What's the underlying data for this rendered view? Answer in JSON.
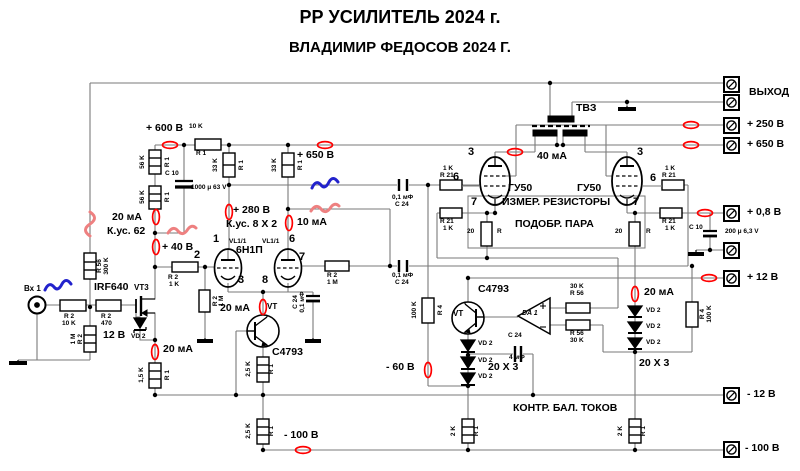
{
  "title": {
    "line1": "РР УСИЛИТЕЛЬ 2024 г.",
    "line2": "ВЛАДИМИР ФЕДОСОВ 2024 Г."
  },
  "colors": {
    "wire": "#7a7a7a",
    "symbol": "#000000",
    "measure_oval": "#ff0000",
    "squiggle_red": "#ee8080",
    "squiggle_blue": "#2222cc"
  },
  "terminals": [
    {
      "name": "terminal-output-1",
      "x": 723,
      "y": 76,
      "label": "ВЫХОД",
      "lx": 749,
      "ly": 87
    },
    {
      "name": "terminal-output-2",
      "x": 723,
      "y": 94,
      "label": "",
      "lx": 0,
      "ly": 0
    },
    {
      "name": "terminal-plus250v",
      "x": 723,
      "y": 117,
      "label": "+ 250 В",
      "lx": 747,
      "ly": 119
    },
    {
      "name": "terminal-plus650v",
      "x": 723,
      "y": 137,
      "label": "+ 650 В",
      "lx": 747,
      "ly": 139
    },
    {
      "name": "terminal-plus0v8",
      "x": 723,
      "y": 205,
      "label": "+ 0,8 В",
      "lx": 747,
      "ly": 207
    },
    {
      "name": "terminal-ground",
      "x": 723,
      "y": 242,
      "label": "",
      "lx": 0,
      "ly": 0
    },
    {
      "name": "terminal-plus12v",
      "x": 723,
      "y": 270,
      "label": "+ 12 В",
      "lx": 747,
      "ly": 272
    },
    {
      "name": "terminal-minus12v",
      "x": 723,
      "y": 387,
      "label": "- 12 В",
      "lx": 747,
      "ly": 389
    },
    {
      "name": "terminal-minus100v",
      "x": 723,
      "y": 441,
      "label": "- 100 В",
      "lx": 745,
      "ly": 443
    }
  ],
  "labels": [
    {
      "name": "label-plus600v",
      "text": "+ 600 В",
      "x": 146,
      "y": 123,
      "cls": "med"
    },
    {
      "name": "label-10k-top",
      "text": "10 K",
      "x": 189,
      "y": 124,
      "cls": "tiny"
    },
    {
      "name": "label-r1-10k",
      "text": "R 1",
      "x": 196,
      "y": 151,
      "cls": "tiny"
    },
    {
      "name": "label-plus650v-mid",
      "text": "+ 650 В",
      "x": 297,
      "y": 150,
      "cls": "med"
    },
    {
      "name": "label-plus280v",
      "text": "+ 280 В",
      "x": 233,
      "y": 205,
      "cls": "med"
    },
    {
      "name": "label-kus8x2",
      "text": "К.ус. 8 X 2",
      "x": 226,
      "y": 219,
      "cls": "med"
    },
    {
      "name": "label-10ma",
      "text": "10 мА",
      "x": 297,
      "y": 217,
      "cls": "med"
    },
    {
      "name": "label-20ma-left",
      "text": "20 мА",
      "x": 112,
      "y": 212,
      "cls": "med"
    },
    {
      "name": "label-kus62",
      "text": "К.ус. 62",
      "x": 107,
      "y": 226,
      "cls": "med"
    },
    {
      "name": "label-plus40v",
      "text": "+ 40 В",
      "x": 162,
      "y": 242,
      "cls": "med"
    },
    {
      "name": "label-12v",
      "text": "12 В",
      "x": 103,
      "y": 330,
      "cls": "med"
    },
    {
      "name": "label-vd2-mosfet",
      "text": "VD 2",
      "x": 131,
      "y": 334,
      "cls": "tiny"
    },
    {
      "name": "label-20ma-leftbottom",
      "text": "20 мА",
      "x": 163,
      "y": 344,
      "cls": "med"
    },
    {
      "name": "label-20ma-center",
      "text": "20 мА",
      "x": 220,
      "y": 303,
      "cls": "med"
    },
    {
      "name": "label-40ma",
      "text": "40 мА",
      "x": 537,
      "y": 151,
      "cls": "med"
    },
    {
      "name": "label-20ma-right",
      "text": "20 мА",
      "x": 644,
      "y": 287,
      "cls": "med"
    },
    {
      "name": "label-minus60v",
      "text": "- 60 В",
      "x": 386,
      "y": 362,
      "cls": "med"
    },
    {
      "name": "label-minus100v-mid",
      "text": "- 100 В",
      "x": 284,
      "y": 430,
      "cls": "med"
    },
    {
      "name": "label-20x3-center",
      "text": "20 X 3",
      "x": 488,
      "y": 362,
      "cls": "med"
    },
    {
      "name": "label-20x3-right",
      "text": "20 X 3",
      "x": 639,
      "y": 358,
      "cls": "med"
    },
    {
      "name": "label-izmer",
      "text": "ИЗМЕР. РЕЗИСТОРЫ",
      "x": 502,
      "y": 197,
      "cls": "med"
    },
    {
      "name": "label-podobr",
      "text": "ПОДОБР. ПАРА",
      "x": 515,
      "y": 219,
      "cls": "med"
    },
    {
      "name": "label-kontr",
      "text": "КОНТР. БАЛ. ТОКОВ",
      "x": 513,
      "y": 403,
      "cls": "med"
    },
    {
      "name": "label-tvz",
      "text": "ТВЗ",
      "x": 576,
      "y": 103,
      "cls": "med"
    },
    {
      "name": "label-irf640",
      "text": "IRF640",
      "x": 94,
      "y": 282,
      "cls": "med"
    },
    {
      "name": "label-vt3",
      "text": "VT3",
      "x": 134,
      "y": 284,
      "cls": "small"
    },
    {
      "name": "label-c4793-center",
      "text": "C4793",
      "x": 272,
      "y": 347,
      "cls": "med"
    },
    {
      "name": "label-c4793-right",
      "text": "C4793",
      "x": 478,
      "y": 284,
      "cls": "med"
    },
    {
      "name": "label-vt-center",
      "text": "VT",
      "x": 267,
      "y": 303,
      "cls": "small"
    },
    {
      "name": "label-vt-right",
      "text": "VT",
      "x": 453,
      "y": 310,
      "cls": "small"
    },
    {
      "name": "label-da1",
      "text": "DA 1",
      "x": 522,
      "y": 310,
      "cls": "ital"
    },
    {
      "name": "label-6n1p",
      "text": "6Н1П",
      "x": 236,
      "y": 245,
      "cls": "med"
    },
    {
      "name": "label-vl11-a",
      "text": "VL1/1",
      "x": 229,
      "y": 239,
      "cls": "tiny"
    },
    {
      "name": "label-vl11-b",
      "text": "VL1/1",
      "x": 262,
      "y": 239,
      "cls": "tiny"
    },
    {
      "name": "label-gu50-left",
      "text": "ГУ50",
      "x": 508,
      "y": 183,
      "cls": "med"
    },
    {
      "name": "label-gu50-right",
      "text": "ГУ50",
      "x": 577,
      "y": 183,
      "cls": "med"
    },
    {
      "name": "label-vh1",
      "text": "Вх 1",
      "x": 24,
      "y": 285,
      "cls": "small"
    },
    {
      "name": "pin-1",
      "text": "1",
      "x": 213,
      "y": 234,
      "cls": "pin"
    },
    {
      "name": "pin-2",
      "text": "2",
      "x": 194,
      "y": 250,
      "cls": "pin"
    },
    {
      "name": "pin-3",
      "text": "3",
      "x": 238,
      "y": 275,
      "cls": "pin"
    },
    {
      "name": "pin-6",
      "text": "6",
      "x": 289,
      "y": 234,
      "cls": "pin"
    },
    {
      "name": "pin-7",
      "text": "7",
      "x": 299,
      "y": 252,
      "cls": "pin"
    },
    {
      "name": "pin-8",
      "text": "8",
      "x": 262,
      "y": 275,
      "cls": "pin"
    },
    {
      "name": "pin-3-gu50l",
      "text": "3",
      "x": 468,
      "y": 147,
      "cls": "pin"
    },
    {
      "name": "pin-6-gu50l",
      "text": "6",
      "x": 453,
      "y": 172,
      "cls": "pin"
    },
    {
      "name": "pin-7-gu50l",
      "text": "7",
      "x": 471,
      "y": 197,
      "cls": "pin"
    },
    {
      "name": "pin-3-gu50r",
      "text": "3",
      "x": 637,
      "y": 147,
      "cls": "pin"
    },
    {
      "name": "pin-6-gu50r",
      "text": "6",
      "x": 650,
      "y": 173,
      "cls": "pin"
    },
    {
      "name": "pin-7-gu50r",
      "text": "7",
      "x": 633,
      "y": 197,
      "cls": "pin"
    },
    {
      "name": "label-c10-left",
      "text": "C 10",
      "x": 165,
      "y": 171,
      "cls": "tiny"
    },
    {
      "name": "label-1000u",
      "text": "1000 μ 63 V",
      "x": 191,
      "y": 185,
      "cls": "tiny"
    },
    {
      "name": "label-cap1-uf",
      "text": "0,1 мФ",
      "x": 392,
      "y": 195,
      "cls": "tiny"
    },
    {
      "name": "label-cap1-c24",
      "text": "C 24",
      "x": 395,
      "y": 202,
      "cls": "tiny"
    },
    {
      "name": "label-cap2-uf",
      "text": "0,1 мФ",
      "x": 392,
      "y": 273,
      "cls": "tiny"
    },
    {
      "name": "label-cap2-c24",
      "text": "C 24",
      "x": 395,
      "y": 280,
      "cls": "tiny"
    },
    {
      "name": "label-r21gl-1",
      "text": "1 K",
      "x": 443,
      "y": 166,
      "cls": "tiny"
    },
    {
      "name": "label-r21gl-2",
      "text": "R 21",
      "x": 440,
      "y": 173,
      "cls": "tiny"
    },
    {
      "name": "label-r21cl-1",
      "text": "R 21",
      "x": 440,
      "y": 219,
      "cls": "tiny"
    },
    {
      "name": "label-r21cl-2",
      "text": "1 K",
      "x": 443,
      "y": 226,
      "cls": "tiny"
    },
    {
      "name": "label-r21gr-1",
      "text": "1 K",
      "x": 665,
      "y": 166,
      "cls": "tiny"
    },
    {
      "name": "label-r21gr-2",
      "text": "R 21",
      "x": 662,
      "y": 173,
      "cls": "tiny"
    },
    {
      "name": "label-r21cr-1",
      "text": "R 21",
      "x": 662,
      "y": 219,
      "cls": "tiny"
    },
    {
      "name": "label-r21cr-2",
      "text": "1 K",
      "x": 665,
      "y": 226,
      "cls": "tiny"
    },
    {
      "name": "label-r56t-1",
      "text": "30 K",
      "x": 570,
      "y": 284,
      "cls": "tiny"
    },
    {
      "name": "label-r56t-2",
      "text": "R 56",
      "x": 570,
      "y": 291,
      "cls": "tiny"
    },
    {
      "name": "label-r56b-1",
      "text": "R 56",
      "x": 570,
      "y": 331,
      "cls": "tiny"
    },
    {
      "name": "label-r56b-2",
      "text": "30 K",
      "x": 570,
      "y": 338,
      "cls": "tiny"
    },
    {
      "name": "label-c24s-1",
      "text": "C 24",
      "x": 508,
      "y": 333,
      "cls": "tiny"
    },
    {
      "name": "label-c24s-2",
      "text": "4 мФ",
      "x": 509,
      "y": 355,
      "cls": "tiny"
    },
    {
      "name": "label-c10-right",
      "text": "C 10",
      "x": 689,
      "y": 225,
      "cls": "tiny"
    },
    {
      "name": "label-200u",
      "text": "200 μ 6,3 V",
      "x": 725,
      "y": 229,
      "cls": "tiny"
    },
    {
      "name": "label-r2in-1",
      "text": "R 2",
      "x": 64,
      "y": 314,
      "cls": "tiny"
    },
    {
      "name": "label-r2in-2",
      "text": "10 K",
      "x": 62,
      "y": 321,
      "cls": "tiny"
    },
    {
      "name": "label-r470-1",
      "text": "R 2",
      "x": 101,
      "y": 314,
      "cls": "tiny"
    },
    {
      "name": "label-r470-2",
      "text": "470",
      "x": 101,
      "y": 321,
      "cls": "tiny"
    },
    {
      "name": "label-r2-1k-1",
      "text": "R 2",
      "x": 168,
      "y": 275,
      "cls": "tiny"
    },
    {
      "name": "label-r2-1k-2",
      "text": "1 K",
      "x": 169,
      "y": 282,
      "cls": "tiny"
    },
    {
      "name": "label-r2-1m-g2-1",
      "text": "R 2",
      "x": 327,
      "y": 273,
      "cls": "tiny"
    },
    {
      "name": "label-r2-1m-g2-2",
      "text": "1 M",
      "x": 327,
      "y": 280,
      "cls": "tiny"
    },
    {
      "name": "label-vd2-c1",
      "text": "VD 2",
      "x": 478,
      "y": 341,
      "cls": "tiny"
    },
    {
      "name": "label-vd2-c2",
      "text": "VD 2",
      "x": 478,
      "y": 358,
      "cls": "tiny"
    },
    {
      "name": "label-vd2-c3",
      "text": "VD 2",
      "x": 478,
      "y": 374,
      "cls": "tiny"
    },
    {
      "name": "label-vd2-r1",
      "text": "VD 2",
      "x": 646,
      "y": 308,
      "cls": "tiny"
    },
    {
      "name": "label-vd2-r2",
      "text": "VD 2",
      "x": 646,
      "y": 324,
      "cls": "tiny"
    },
    {
      "name": "label-vd2-r3",
      "text": "VD 2",
      "x": 646,
      "y": 340,
      "cls": "tiny"
    },
    {
      "name": "label-20l",
      "text": "20",
      "x": 467,
      "y": 229,
      "cls": "tiny"
    },
    {
      "name": "label-rl",
      "text": "R",
      "x": 497,
      "y": 229,
      "cls": "tiny"
    },
    {
      "name": "label-20r",
      "text": "20",
      "x": 615,
      "y": 229,
      "cls": "tiny"
    },
    {
      "name": "label-rr",
      "text": "R",
      "x": 646,
      "y": 229,
      "cls": "tiny"
    },
    {
      "name": "rot-56k-1",
      "text": "56 K",
      "x": 143,
      "y": 162,
      "cls": "rot"
    },
    {
      "name": "rot-r1-a",
      "text": "R 1",
      "x": 168,
      "y": 162,
      "cls": "rot"
    },
    {
      "name": "rot-56k-2",
      "text": "56 K",
      "x": 143,
      "y": 197,
      "cls": "rot"
    },
    {
      "name": "rot-r1-b",
      "text": "R 1",
      "x": 168,
      "y": 197,
      "cls": "rot"
    },
    {
      "name": "rot-33k-1",
      "text": "33 K",
      "x": 216,
      "y": 165,
      "cls": "rot"
    },
    {
      "name": "rot-r1-c",
      "text": "R 1",
      "x": 242,
      "y": 165,
      "cls": "rot"
    },
    {
      "name": "rot-33k-2",
      "text": "33 K",
      "x": 275,
      "y": 165,
      "cls": "rot"
    },
    {
      "name": "rot-r1-d",
      "text": "R 1",
      "x": 301,
      "y": 165,
      "cls": "rot"
    },
    {
      "name": "rot-r56",
      "text": "R 56",
      "x": 100,
      "y": 266,
      "cls": "rot"
    },
    {
      "name": "rot-300k",
      "text": "300 K",
      "x": 107,
      "y": 266,
      "cls": "rot"
    },
    {
      "name": "rot-1m-in",
      "text": "1 M",
      "x": 74,
      "y": 339,
      "cls": "rot"
    },
    {
      "name": "rot-r2-in",
      "text": "R 2",
      "x": 81,
      "y": 339,
      "cls": "rot"
    },
    {
      "name": "rot-r2-g1",
      "text": "R 2",
      "x": 216,
      "y": 301,
      "cls": "rot"
    },
    {
      "name": "rot-1m-g1",
      "text": "1 M",
      "x": 222,
      "y": 301,
      "cls": "rot"
    },
    {
      "name": "rot-15k",
      "text": "1,5 K",
      "x": 142,
      "y": 375,
      "cls": "rot"
    },
    {
      "name": "rot-r1-e",
      "text": "R 1",
      "x": 168,
      "y": 375,
      "cls": "rot"
    },
    {
      "name": "rot-25k-a",
      "text": "2,5 K",
      "x": 249,
      "y": 369,
      "cls": "rot"
    },
    {
      "name": "rot-r1-f",
      "text": "R 1",
      "x": 272,
      "y": 369,
      "cls": "rot"
    },
    {
      "name": "rot-25k-b",
      "text": "2,5 K",
      "x": 249,
      "y": 431,
      "cls": "rot"
    },
    {
      "name": "rot-r1-g",
      "text": "R 1",
      "x": 272,
      "y": 431,
      "cls": "rot"
    },
    {
      "name": "rot-100k-l",
      "text": "100 K",
      "x": 415,
      "y": 310,
      "cls": "rot"
    },
    {
      "name": "rot-r4-l",
      "text": "R 4",
      "x": 441,
      "y": 310,
      "cls": "rot"
    },
    {
      "name": "rot-r4-r",
      "text": "R 4",
      "x": 703,
      "y": 314,
      "cls": "rot"
    },
    {
      "name": "rot-100k-r",
      "text": "100 K",
      "x": 710,
      "y": 314,
      "cls": "rot"
    },
    {
      "name": "rot-2k-l",
      "text": "2 K",
      "x": 454,
      "y": 431,
      "cls": "rot"
    },
    {
      "name": "rot-r1-h",
      "text": "R 1",
      "x": 477,
      "y": 431,
      "cls": "rot"
    },
    {
      "name": "rot-2k-r",
      "text": "2 K",
      "x": 621,
      "y": 431,
      "cls": "rot"
    },
    {
      "name": "rot-r1-i",
      "text": "R 1",
      "x": 644,
      "y": 431,
      "cls": "rot"
    },
    {
      "name": "rot-c24-byp",
      "text": "C 24",
      "x": 296,
      "y": 302,
      "cls": "rot"
    },
    {
      "name": "rot-01uf-byp",
      "text": "0,1 мФ",
      "x": 303,
      "y": 302,
      "cls": "rot"
    }
  ]
}
